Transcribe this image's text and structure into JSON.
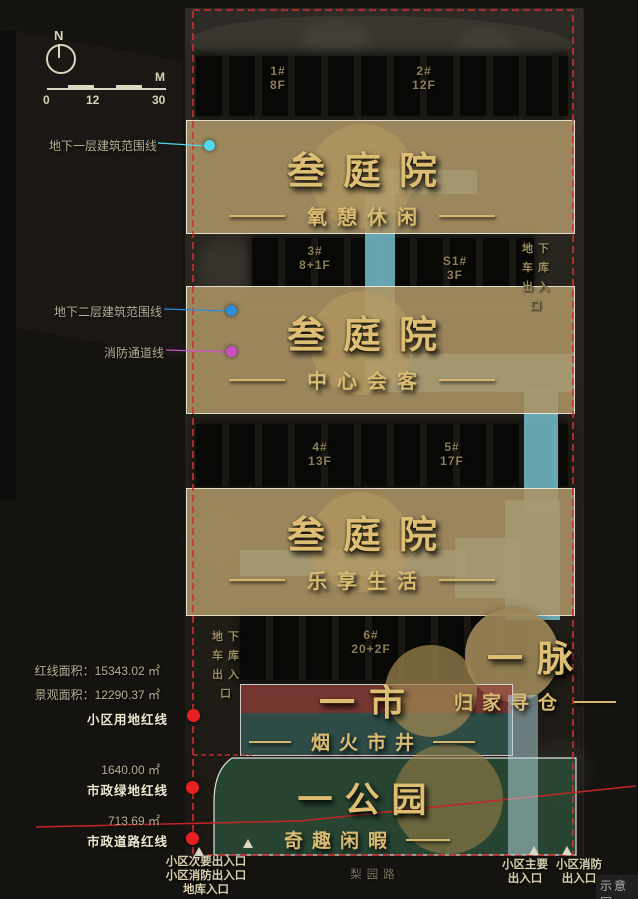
{
  "compass": {
    "north_label": "N"
  },
  "scale_bar": {
    "t0": "0",
    "t12": "12",
    "t30": "30",
    "unit": "M"
  },
  "legend": {
    "basement1": "地下一层建筑范围线",
    "basement2": "地下二层建筑范围线",
    "fire_lane": "消防通道线",
    "colors": {
      "basement1": "#52d9ec",
      "basement2": "#2d8fd9",
      "fire_lane": "#cb4fc6",
      "red_line": "#e62020"
    }
  },
  "areas": {
    "red_line_area": "红线面积：15343.02 ㎡",
    "landscape_area": "景观面积：12290.37 ㎡",
    "plot_red_line": "小区用地红线",
    "municipal_green_value": "1640.00 ㎡",
    "municipal_green_line": "市政绿地红线",
    "municipal_road_value": "713.69 ㎡",
    "municipal_road_line": "市政道路红线"
  },
  "zones": {
    "courtyard1": {
      "title": "叁庭院",
      "subtitle": "氧憩休闲"
    },
    "courtyard2": {
      "title": "叁庭院",
      "subtitle": "中心会客"
    },
    "courtyard3": {
      "title": "叁庭院",
      "subtitle": "乐享生活"
    },
    "vein": {
      "title": "一脉",
      "subtitle": "归家寻仓"
    },
    "market": {
      "title": "一市",
      "subtitle": "烟火市井"
    },
    "park": {
      "title": "一公园",
      "subtitle": "奇趣闲暇"
    }
  },
  "buildings": [
    {
      "no": "1#",
      "floors": "8F"
    },
    {
      "no": "2#",
      "floors": "12F"
    },
    {
      "no": "3#",
      "floors": "8+1F"
    },
    {
      "no": "S1#",
      "floors": "3F"
    },
    {
      "no": "4#",
      "floors": "13F"
    },
    {
      "no": "5#",
      "floors": "17F"
    },
    {
      "no": "6#",
      "floors": "20+2F"
    }
  ],
  "garage_entry_rows": [
    "地下",
    "车库",
    "出入",
    "口"
  ],
  "bottom": {
    "secondary_entry": "小区次要出入口",
    "fire_entry_left": "小区消防出入口",
    "garage_entry": "地库入口",
    "road_name": "梨园路",
    "main_entry_l1": "小区主要",
    "main_entry_l2": "出入口",
    "fire_entry_r1": "小区消防",
    "fire_entry_r2": "出入口",
    "watermark": "示意图"
  },
  "colors": {
    "accent_gold": "#d9b96b",
    "boundary_red": "#d03030",
    "water_cyan": "#79c6d5",
    "zone_tan": "#ac9465",
    "market_red": "#96403a",
    "market_teal": "#386964",
    "park_green": "#2a4e38"
  }
}
